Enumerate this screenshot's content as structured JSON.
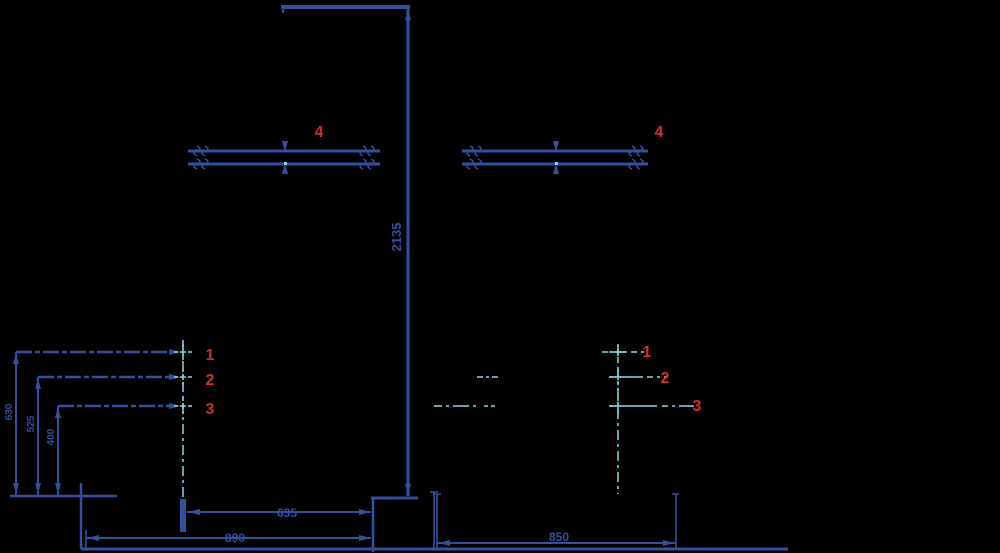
{
  "drawing": {
    "type": "installation-dimension-drawing",
    "colors": {
      "background": "#000000",
      "line_blue": "#3350a0",
      "accent_red": "#d22d28",
      "centerline_cyan": "#87dce6"
    },
    "part_labels": {
      "p1": "1",
      "p2": "2",
      "p3": "3",
      "p4": "4"
    },
    "dimensions": {
      "total_height": "2135",
      "hole1_height": "630",
      "hole2_height": "525",
      "hole3_height": "400",
      "inner_width": "635",
      "outer_width": "890",
      "right_width": "850"
    }
  }
}
